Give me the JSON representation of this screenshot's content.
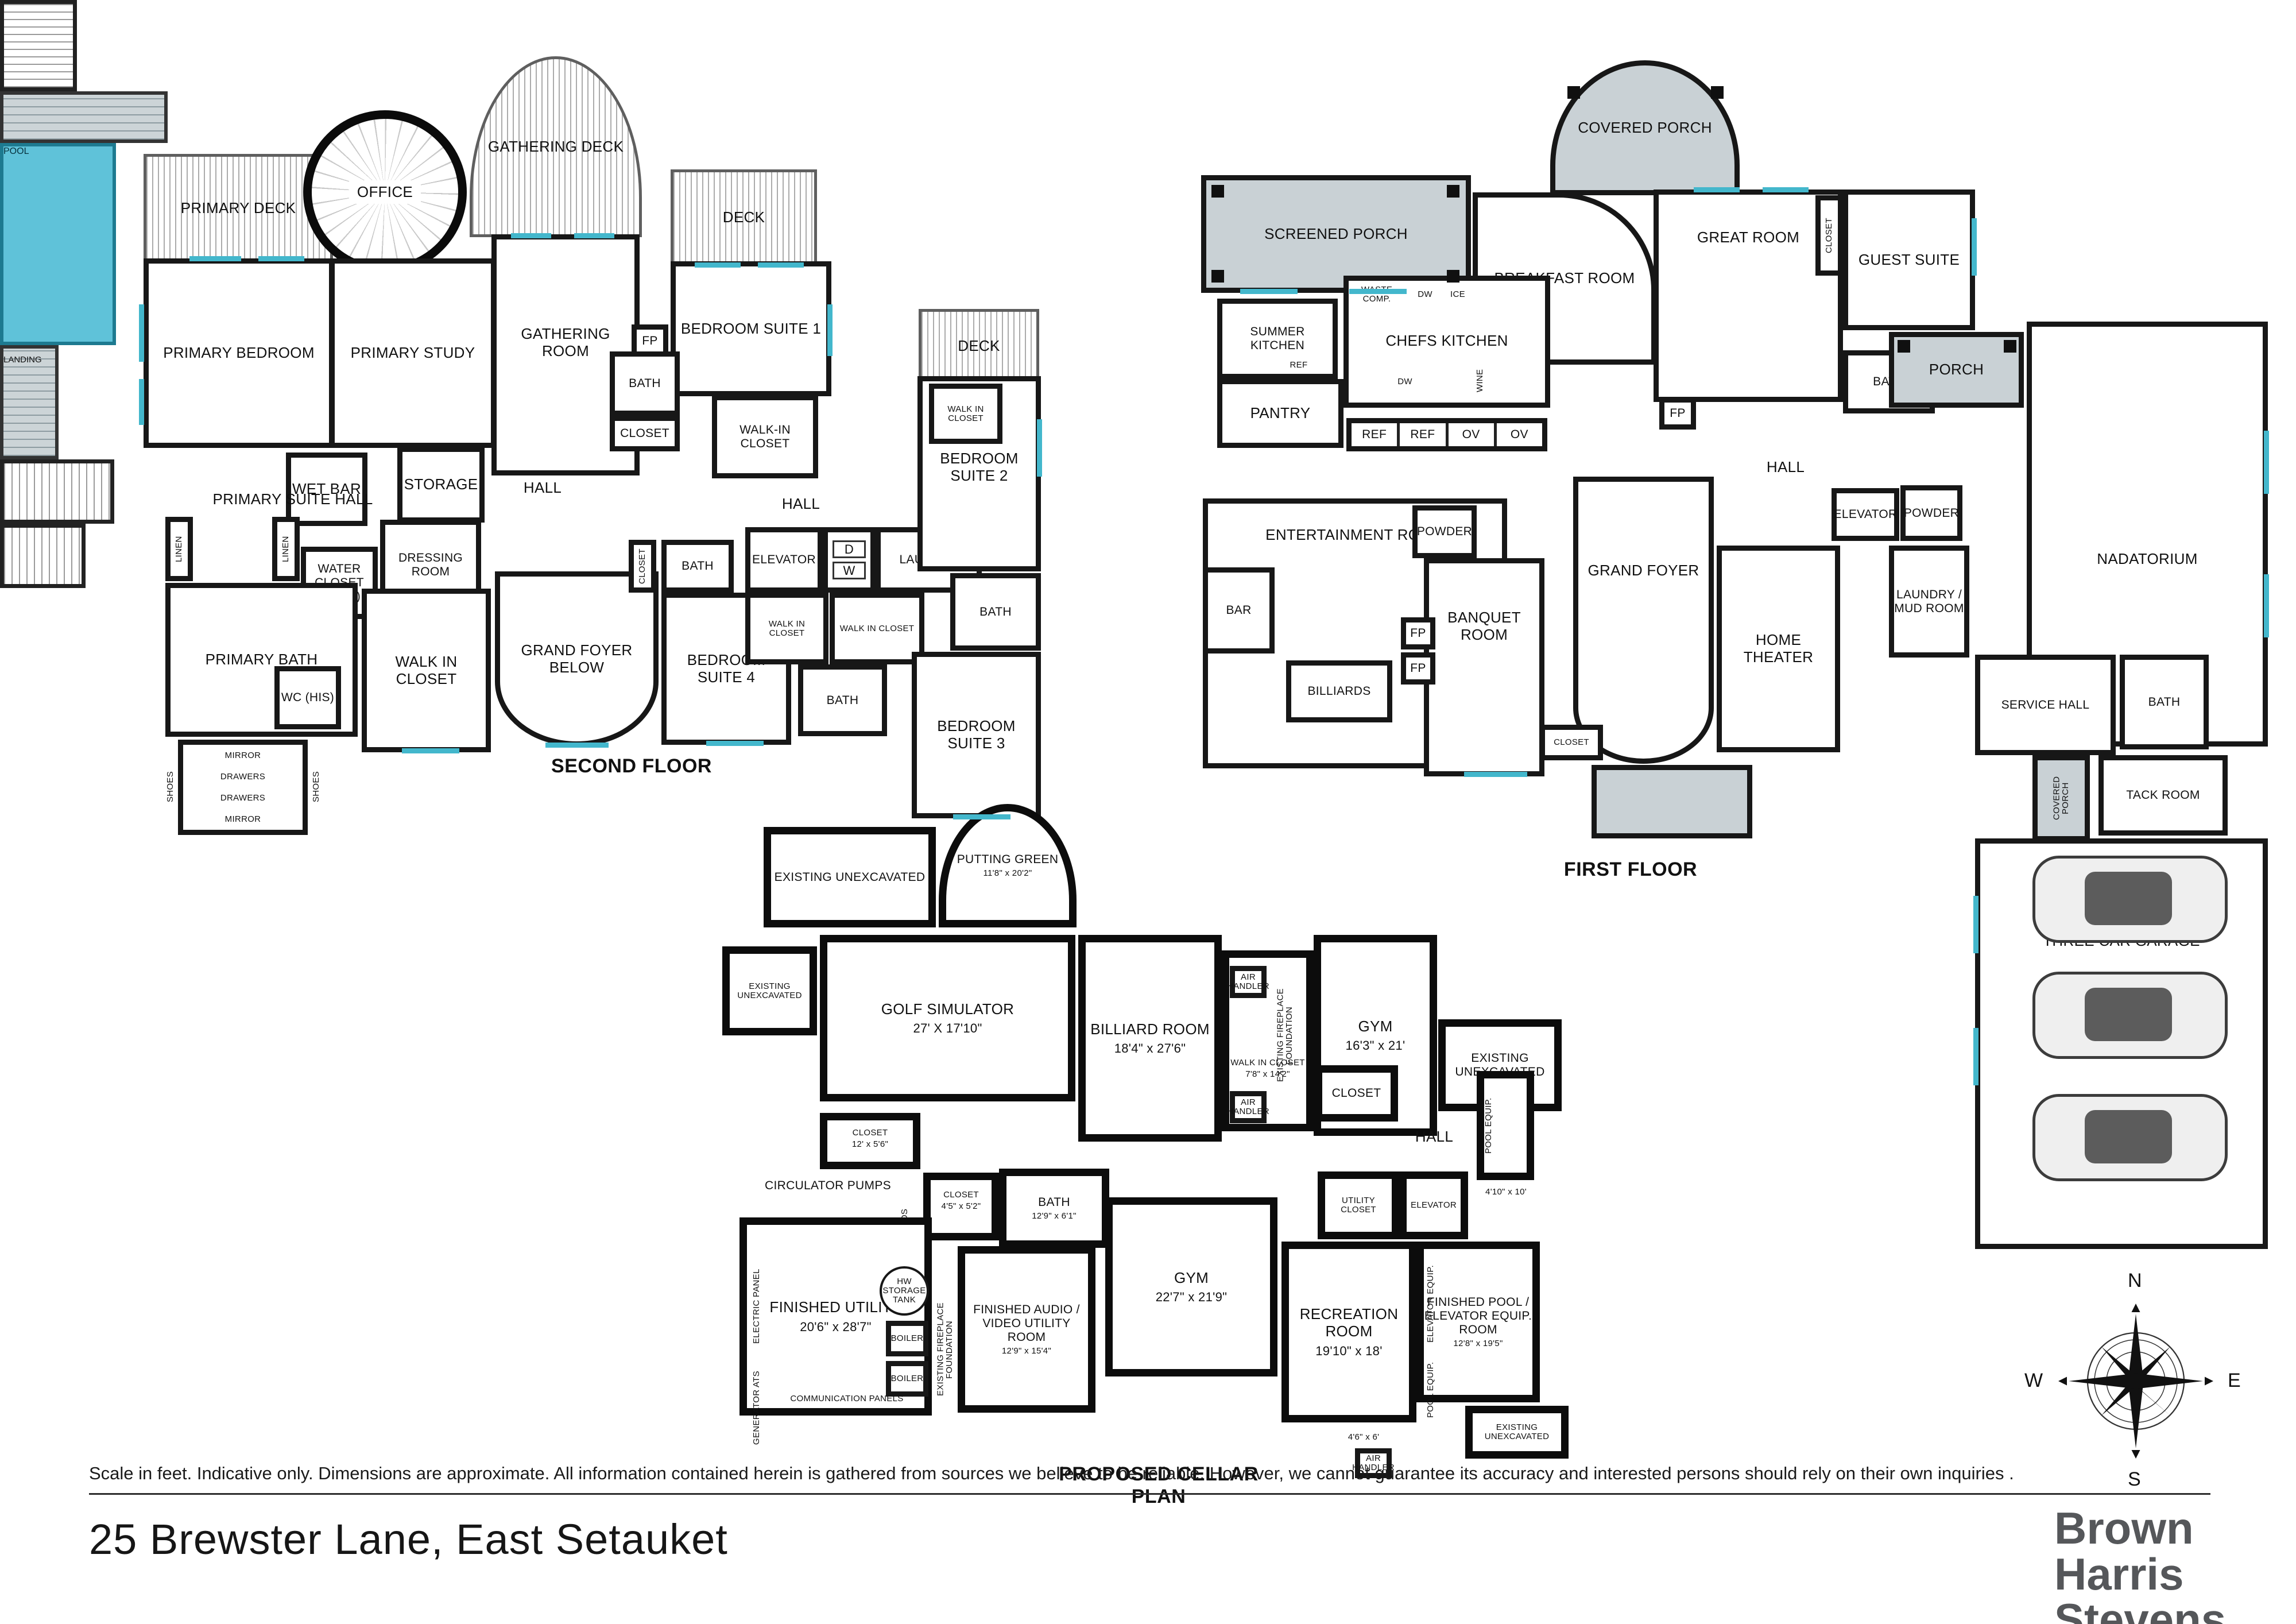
{
  "second": {
    "title": "SECOND FLOOR",
    "rooms": {
      "primary_deck": "PRIMARY DECK",
      "office": "OFFICE",
      "gathering_deck": "GATHERING DECK",
      "deck_ne": "DECK",
      "deck_e": "DECK",
      "primary_bedroom": "PRIMARY BEDROOM",
      "primary_study": "PRIMARY STUDY",
      "gathering_room": "GATHERING ROOM",
      "fp": "FP",
      "bedroom_suite_1": "BEDROOM SUITE 1",
      "bath_suite_1": "BATH",
      "closet_hall": "CLOSET",
      "walk_in_closet_1": "WALK-IN CLOSET",
      "wet_bar": "WET BAR",
      "storage": "STORAGE",
      "primary_suite_hall": "PRIMARY SUITE HALL",
      "hall_center": "HALL",
      "hall_east": "HALL",
      "linen_1": "LINEN",
      "linen_2": "LINEN",
      "water_closet_hers": "WATER CLOSET (HERS)",
      "dressing_room": "DRESSING ROOM",
      "primary_bath": "PRIMARY BATH",
      "wc_his": "WC (HIS)",
      "walk_in_closet_primary": "WALK IN CLOSET",
      "mirror_top": "MIRROR",
      "mirror_bottom": "MIRROR",
      "drawers_left": "DRAWERS",
      "drawers_right": "DRAWERS",
      "shoes_left": "SHOES",
      "shoes_right": "SHOES",
      "grand_foyer_below": "GRAND FOYER BELOW",
      "bath_suite_4": "BATH",
      "closet_suite_4": "CLOSET",
      "bedroom_suite_4": "BEDROOM SUITE 4",
      "elevator": "ELEVATOR",
      "dryer": "D",
      "washer": "W",
      "laundry": "LAUNDRY",
      "walk_in_closet_a": "WALK IN CLOSET",
      "walk_in_closet_b": "WALK IN CLOSET",
      "bath_center": "BATH",
      "bedroom_suite_2": "BEDROOM SUITE 2",
      "walk_in_closet_2": "WALK IN CLOSET",
      "bath_suite_2": "BATH",
      "bedroom_suite_3": "BEDROOM SUITE 3"
    }
  },
  "first": {
    "title": "FIRST FLOOR",
    "rooms": {
      "covered_porch": "COVERED PORCH",
      "screened_porch": "SCREENED PORCH",
      "breakfast_room": "BREAKFAST ROOM",
      "great_room": "GREAT ROOM",
      "guest_suite": "GUEST SUITE",
      "closet_guest": "CLOSET",
      "summer_kitchen": "SUMMER KITCHEN",
      "ref_summer": "REF",
      "trays": "TRAYS",
      "chefs_kitchen": "CHEFS KITCHEN",
      "waste_comp": "WASTE COMP.",
      "dw_1": "DW",
      "ice": "ICE",
      "dw_2": "DW",
      "wine": "WINE",
      "pantry": "PANTRY",
      "ref_1": "REF",
      "ref_2": "REF",
      "ov_1": "OV",
      "ov_2": "OV",
      "entertainment_room": "ENTERTAINMENT ROOM",
      "bar": "BAR",
      "billiards": "BILLIARDS",
      "powder_west": "POWDER",
      "banquet_room": "BANQUET ROOM",
      "fp_1": "FP",
      "fp_2": "FP",
      "fp_great": "FP",
      "grand_foyer": "GRAND FOYER",
      "closet_foyer": "CLOSET",
      "hall": "HALL",
      "bath_guest": "BATH",
      "elevator": "ELEVATOR",
      "powder_east": "POWDER",
      "home_theater": "HOME THEATER",
      "laundry_mud_room": "LAUNDRY / MUD ROOM",
      "porch": "PORCH",
      "pool": "POOL",
      "nadatorium": "NADATORIUM",
      "service_hall": "SERVICE HALL",
      "bath_service": "BATH",
      "covered_porch_side": "COVERED PORCH",
      "tack_room": "TACK ROOM",
      "three_car_garage": "THREE CAR GARAGE"
    }
  },
  "cellar": {
    "title": "PROPOSED CELLAR PLAN",
    "rooms": {
      "unexcavated_1": "EXISTING UNEXCAVATED",
      "unexcavated_2": "EXISTING UNEXCAVATED",
      "unexcavated_3": "EXISTING UNEXCAVATED",
      "unexcavated_4": "EXISTING UNEXCAVATED",
      "putting_green": "PUTTING GREEN",
      "putting_green_dims": "11'8\" x 20'2\"",
      "landing": "LANDING",
      "golf_simulator": "GOLF SIMULATOR",
      "golf_simulator_dims": "27' X 17'10\"",
      "billiard_room": "BILLIARD ROOM",
      "billiard_room_dims": "18'4\" x 27'6\"",
      "walk_in_closet": "WALK IN CLOSET",
      "walk_in_closet_dims": "7'8\" x 14'2\"",
      "fireplace_foundation_1": "EXISTING FIREPLACE FOUNDATION",
      "fireplace_foundation_2": "EXISTING FIREPLACE FOUNDATION",
      "air_handler_1": "AIR HANDLER",
      "air_handler_2": "AIR HANDLER",
      "air_handler_3": "AIR HANDLER",
      "gym_east": "GYM",
      "gym_east_dims": "16'3\" x 21'",
      "closet_stair": "CLOSET",
      "closet_stair_dims": "12' x 5'6\"",
      "circulator_pumps": "CIRCULATOR PUMPS",
      "manifolds": "MANIFOLDS",
      "closet_small": "CLOSET",
      "closet_small_dims": "4'5\" x 5'2\"",
      "bath": "BATH",
      "bath_dims": "12'9\" x 6'1\"",
      "electric_panel": "ELECTRIC PANEL",
      "finished_utility": "FINISHED UTILITY",
      "finished_utility_dims": "20'6\" x 28'7\"",
      "hw_storage_tank": "HW STORAGE TANK",
      "boiler_1": "BOILER",
      "boiler_2": "BOILER",
      "generator_ats": "GENERATOR ATS",
      "communication_panels": "COMMUNICATION PANELS",
      "finished_av": "FINISHED AUDIO / VIDEO UTILITY ROOM",
      "finished_av_dims": "12'9\" x 15'4\"",
      "gym_west": "GYM",
      "gym_west_dims": "22'7\" x 21'9\"",
      "closet_hall": "CLOSET",
      "hall": "HALL",
      "pool_equip_1": "POOL EQUIP.",
      "pool_equip_1_dims": "4'10\" x 10'",
      "utility_closet": "UTILITY CLOSET",
      "elevator": "ELEVATOR",
      "recreation_room": "RECREATION ROOM",
      "recreation_room_dims": "19'10\" x 18'",
      "elevator_equip": "ELEVATOR EQUIP.",
      "pool_elevator_room": "FINISHED POOL / ELEVATOR EQUIP. ROOM",
      "pool_elevator_room_dims": "12'8\" x 19'5\"",
      "pool_equip_2": "POOL EQUIP.",
      "room_4_6": "4'6\" x 6'"
    }
  },
  "footer": {
    "disclaimer": "Scale in feet. Indicative only. Dimensions are approximate. All information contained herein is gathered from sources we believe to be reliable. However, we cannot guarantee its accuracy and interested persons should rely on their own inquiries .",
    "address": "25 Brewster Lane, East Setauket",
    "brand_1": "Brown",
    "brand_2": "Harris",
    "brand_3": "Stevens"
  },
  "compass": {
    "north": "N",
    "east": "E",
    "south": "S",
    "west": "W"
  }
}
